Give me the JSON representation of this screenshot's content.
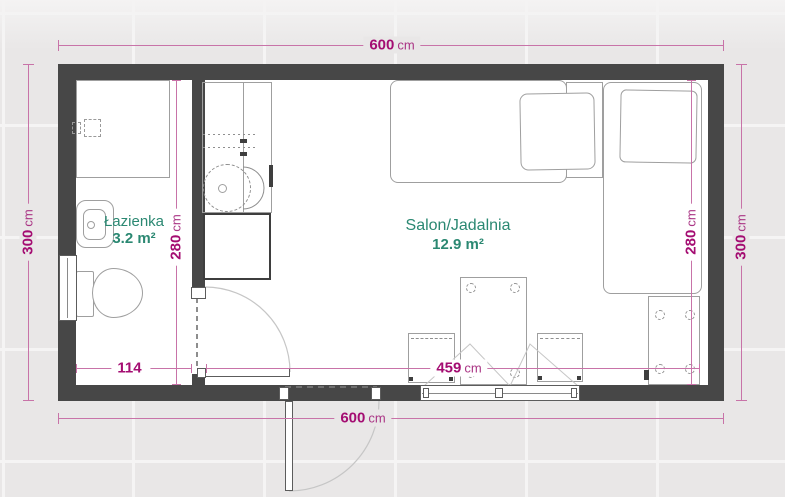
{
  "plan": {
    "type": "floor-plan",
    "rooms": [
      {
        "name": "Łazienka",
        "area": "3.2 m²"
      },
      {
        "name": "Salon/Jadalnia",
        "area": "12.9 m²"
      }
    ],
    "dimensions": {
      "top": {
        "value": "600",
        "unit": "cm"
      },
      "bottom": {
        "value": "600",
        "unit": "cm"
      },
      "left": {
        "value": "300",
        "unit": "cm"
      },
      "right": {
        "value": "300",
        "unit": "cm"
      },
      "bath_height": {
        "value": "280",
        "unit": "cm"
      },
      "salon_height": {
        "value": "280",
        "unit": "cm"
      },
      "bath_width": {
        "value": "114",
        "unit": ""
      },
      "salon_width": {
        "value": "459",
        "unit": "cm"
      }
    },
    "fixtures": [
      "shower",
      "washbasin",
      "toilet",
      "kitchen-cabinet",
      "kitchen-sink",
      "kitchen-counter",
      "bed-horizontal",
      "nightstand",
      "bed-vertical",
      "duvet",
      "dining-table",
      "chair",
      "desk",
      "window-left",
      "window-bottom",
      "entry-door",
      "bathroom-door"
    ],
    "colors": {
      "wall": "#474747",
      "dimension_text": "#a40d72",
      "dimension_line": "#c873a8",
      "room_label": "#2b8872",
      "furniture_line": "#9f9f9f",
      "background": "#e9e7e7"
    }
  }
}
